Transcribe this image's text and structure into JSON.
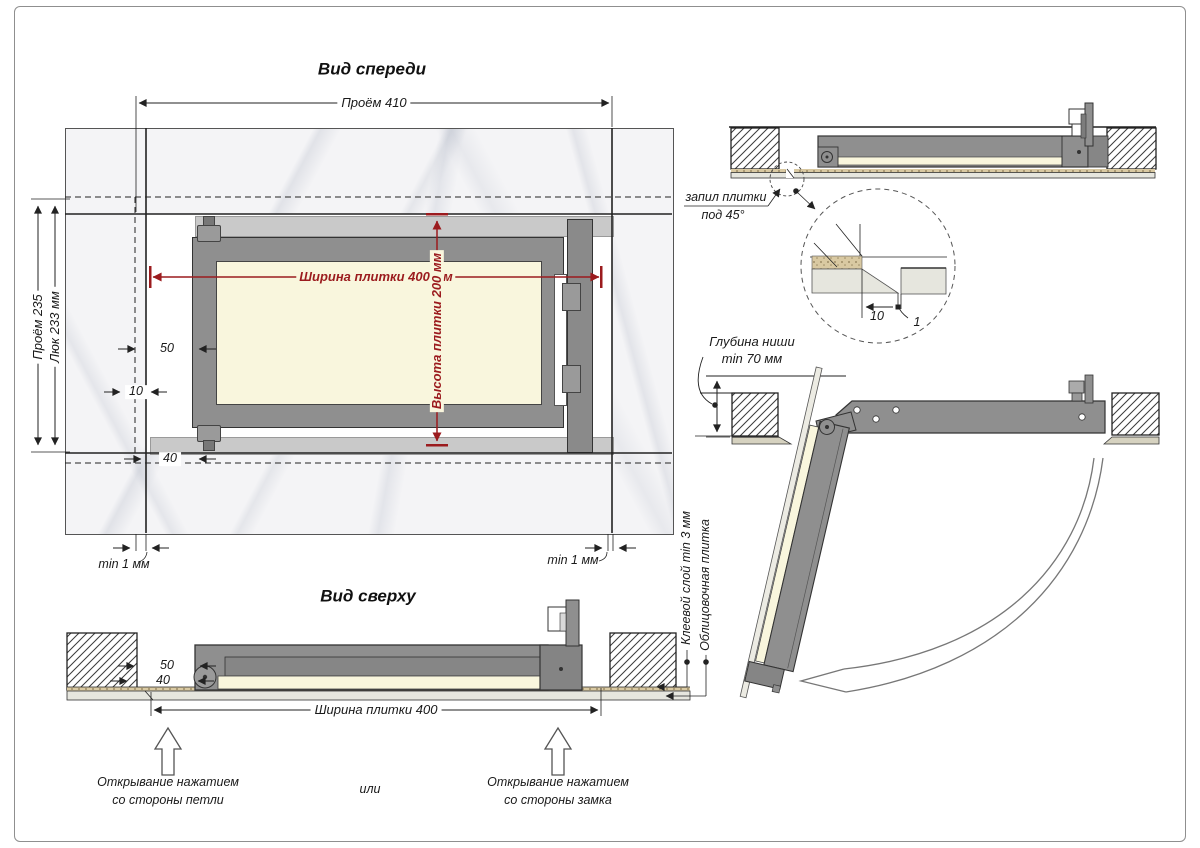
{
  "drawing": {
    "front_view": {
      "title": "Вид спереди",
      "dims": {
        "opening_width": "Проём 410",
        "opening_height": "Проём 235",
        "hatch_height": "Люк 233 мм",
        "tile_width": "Ширина плитки 400 мм",
        "tile_height": "Высота плитки 200 мм",
        "offset_50": "50",
        "offset_10": "10",
        "offset_40": "40",
        "gap_left": "min 1 мм",
        "gap_right": "min 1 мм"
      }
    },
    "top_view": {
      "title": "Вид сверху",
      "dims": {
        "tile_width": "Ширина плитки 400",
        "offset_50": "50",
        "offset_40": "40"
      },
      "labels": {
        "adhesive": "Клеевой слой min 3 мм",
        "tile": "Облицовочная плитка"
      }
    },
    "section_view": {
      "labels": {
        "tile_cut_line1": "запил плитки",
        "tile_cut_line2": "под 45°",
        "niche_depth_line1": "Глубина ниши",
        "niche_depth_line2": "min 70 мм"
      },
      "detail": {
        "dim_10": "10",
        "dim_1": "1"
      }
    },
    "footer": {
      "hinge_side_line1": "Открывание нажатием",
      "hinge_side_line2": "со стороны петли",
      "or": "или",
      "lock_side_line1": "Открывание нажатием",
      "lock_side_line2": "со стороны замка"
    },
    "colors": {
      "dimension_red": "#9b1b1e",
      "frame_gray": "#8f8f8f",
      "door_tile_cream": "#f9f6dd",
      "wall_tile_marble": "#f5f5f7"
    }
  }
}
